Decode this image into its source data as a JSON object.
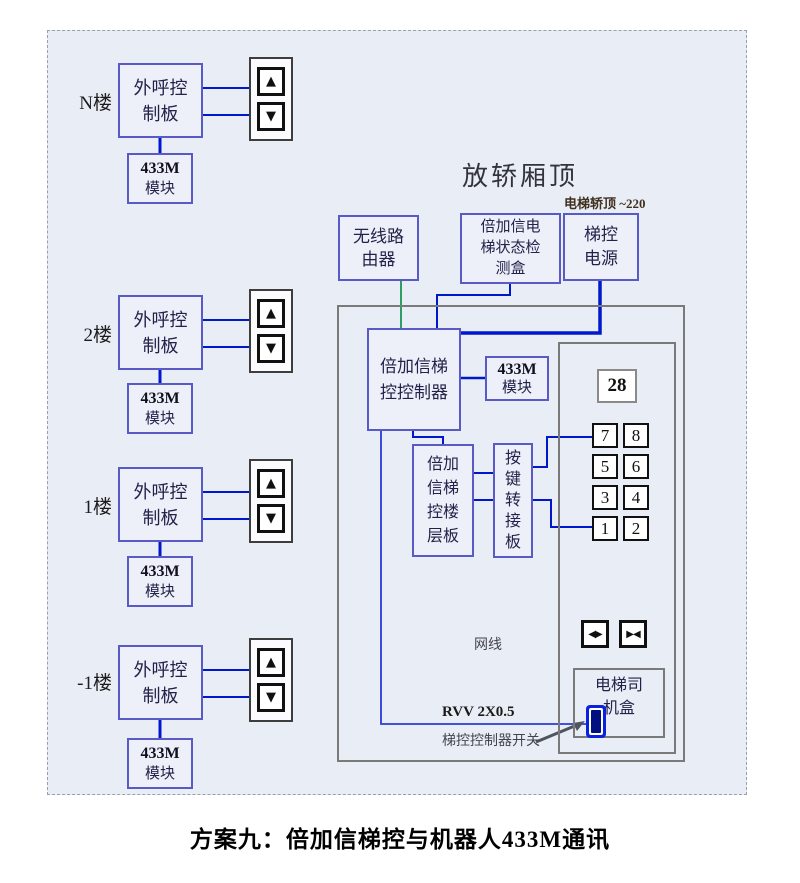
{
  "caption": "方案九：倍加信梯控与机器人433M通讯",
  "colors": {
    "background": "#e9edf6",
    "component_border_blue": "#5a5ac6",
    "structure_border_gray": "#7a7a7a",
    "wire_blue": "#0018cc",
    "wire_green": "#2f9e62",
    "switch_blue": "#0a22dd"
  },
  "icons": {
    "up": "▲",
    "down": "▼",
    "door_open": "◀▶",
    "door_close": "▶◀"
  },
  "floors": [
    {
      "label": "N楼",
      "board_line1": "外呼控",
      "board_line2": "制板",
      "module_line1": "433M",
      "module_line2": "模块"
    },
    {
      "label": "2楼",
      "board_line1": "外呼控",
      "board_line2": "制板",
      "module_line1": "433M",
      "module_line2": "模块"
    },
    {
      "label": "1楼",
      "board_line1": "外呼控",
      "board_line2": "制板",
      "module_line1": "433M",
      "module_line2": "模块"
    },
    {
      "label": "-1楼",
      "board_line1": "外呼控",
      "board_line2": "制板",
      "module_line1": "433M",
      "module_line2": "模块"
    }
  ],
  "cartop": {
    "title": "放轿厢顶",
    "power_note": "电梯轿顶 ~220",
    "router_line1": "无线路",
    "router_line2": "由器",
    "detector_line1": "倍加信电",
    "detector_line2": "梯状态检",
    "detector_line3": "测盒",
    "power_line1": "梯控",
    "power_line2": "电源",
    "controller_line1": "倍加信梯",
    "controller_line2": "控控制器",
    "module_line1": "433M",
    "module_line2": "模块",
    "floorboard_line1": "倍加",
    "floorboard_line2": "信梯",
    "floorboard_line3": "控楼",
    "floorboard_line4": "层板",
    "adapter_line1": "按",
    "adapter_line2": "键",
    "adapter_line3": "转",
    "adapter_line4": "接",
    "adapter_line5": "板",
    "display_value": "28",
    "keypad": [
      [
        "7",
        "8"
      ],
      [
        "5",
        "6"
      ],
      [
        "3",
        "4"
      ],
      [
        "1",
        "2"
      ]
    ],
    "driver_line1": "电梯司",
    "driver_line2": "机盒",
    "label_network": "网线",
    "label_rvv": "RVV 2X0.5",
    "label_switch": "梯控控制器开关"
  }
}
